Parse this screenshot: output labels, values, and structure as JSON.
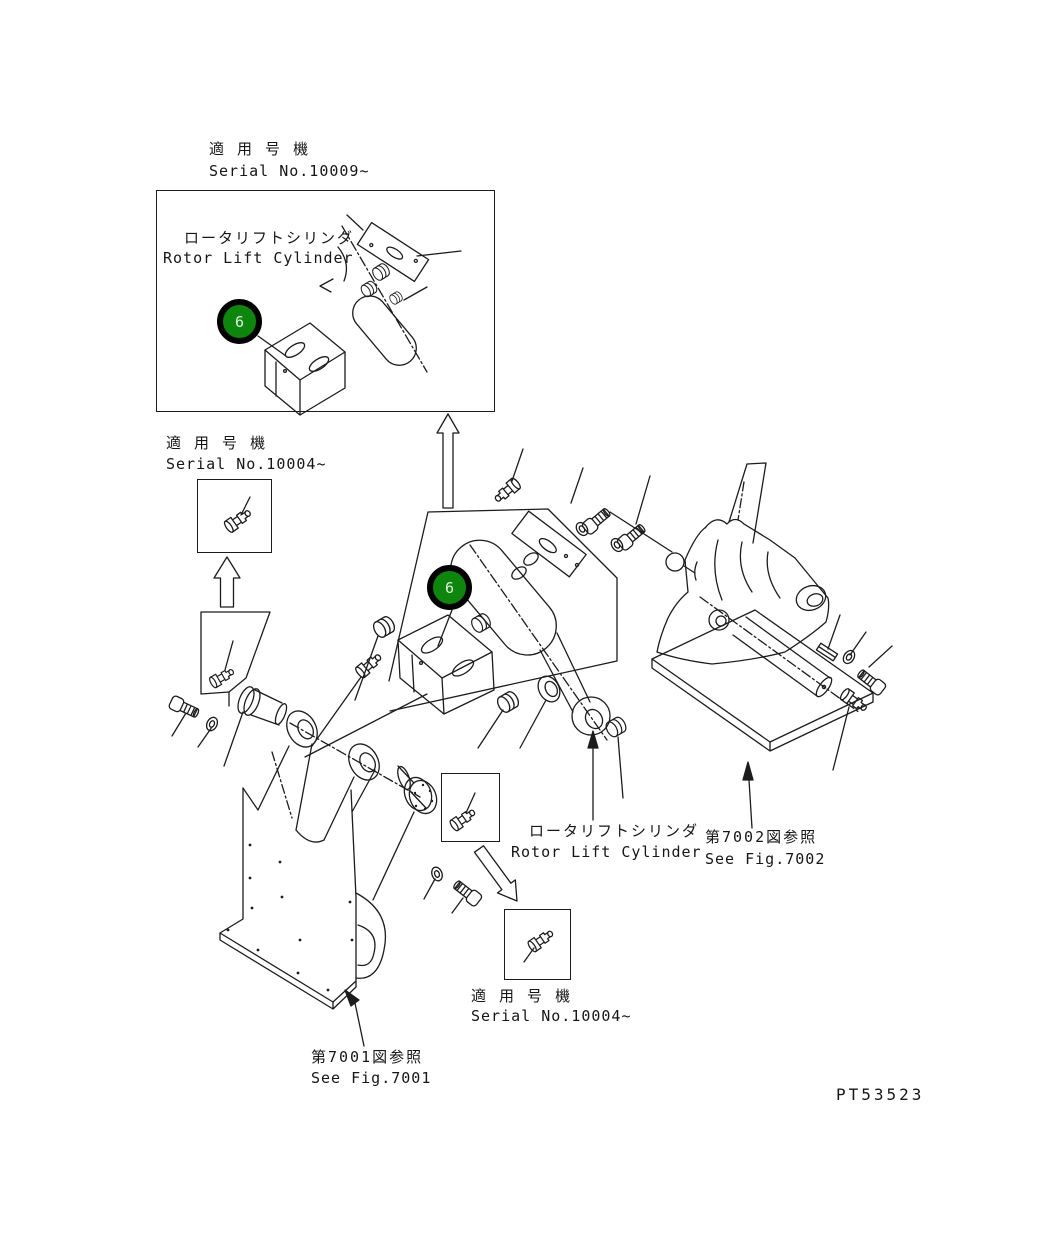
{
  "doc": {
    "part_number": "PT53523",
    "line_color": "#1c1c1c",
    "balloon_fill": "#0e860e",
    "balloon_ring": "#000000"
  },
  "labels": {
    "serial_top": {
      "jp": "適 用 号 機",
      "en": "Serial No.10009~"
    },
    "serial_left": {
      "jp": "適 用 号 機",
      "en": "Serial No.10004~"
    },
    "serial_bottom": {
      "jp": "適 用 号 機",
      "en": "Serial No.10004~"
    },
    "rotor_top": {
      "jp": "ロータリフトシリンダ",
      "en": "Rotor Lift Cylinder"
    },
    "rotor_mid": {
      "jp": "ロータリフトシリンダ",
      "en": "Rotor Lift Cylinder"
    },
    "see_fig_7002": {
      "jp": "第7002図参照",
      "en": "See Fig.7002"
    },
    "see_fig_7001": {
      "jp": "第7001図参照",
      "en": "See Fig.7001"
    }
  },
  "parts": {
    "item6_top": {
      "number": "6"
    },
    "item6_main": {
      "number": "6"
    }
  }
}
